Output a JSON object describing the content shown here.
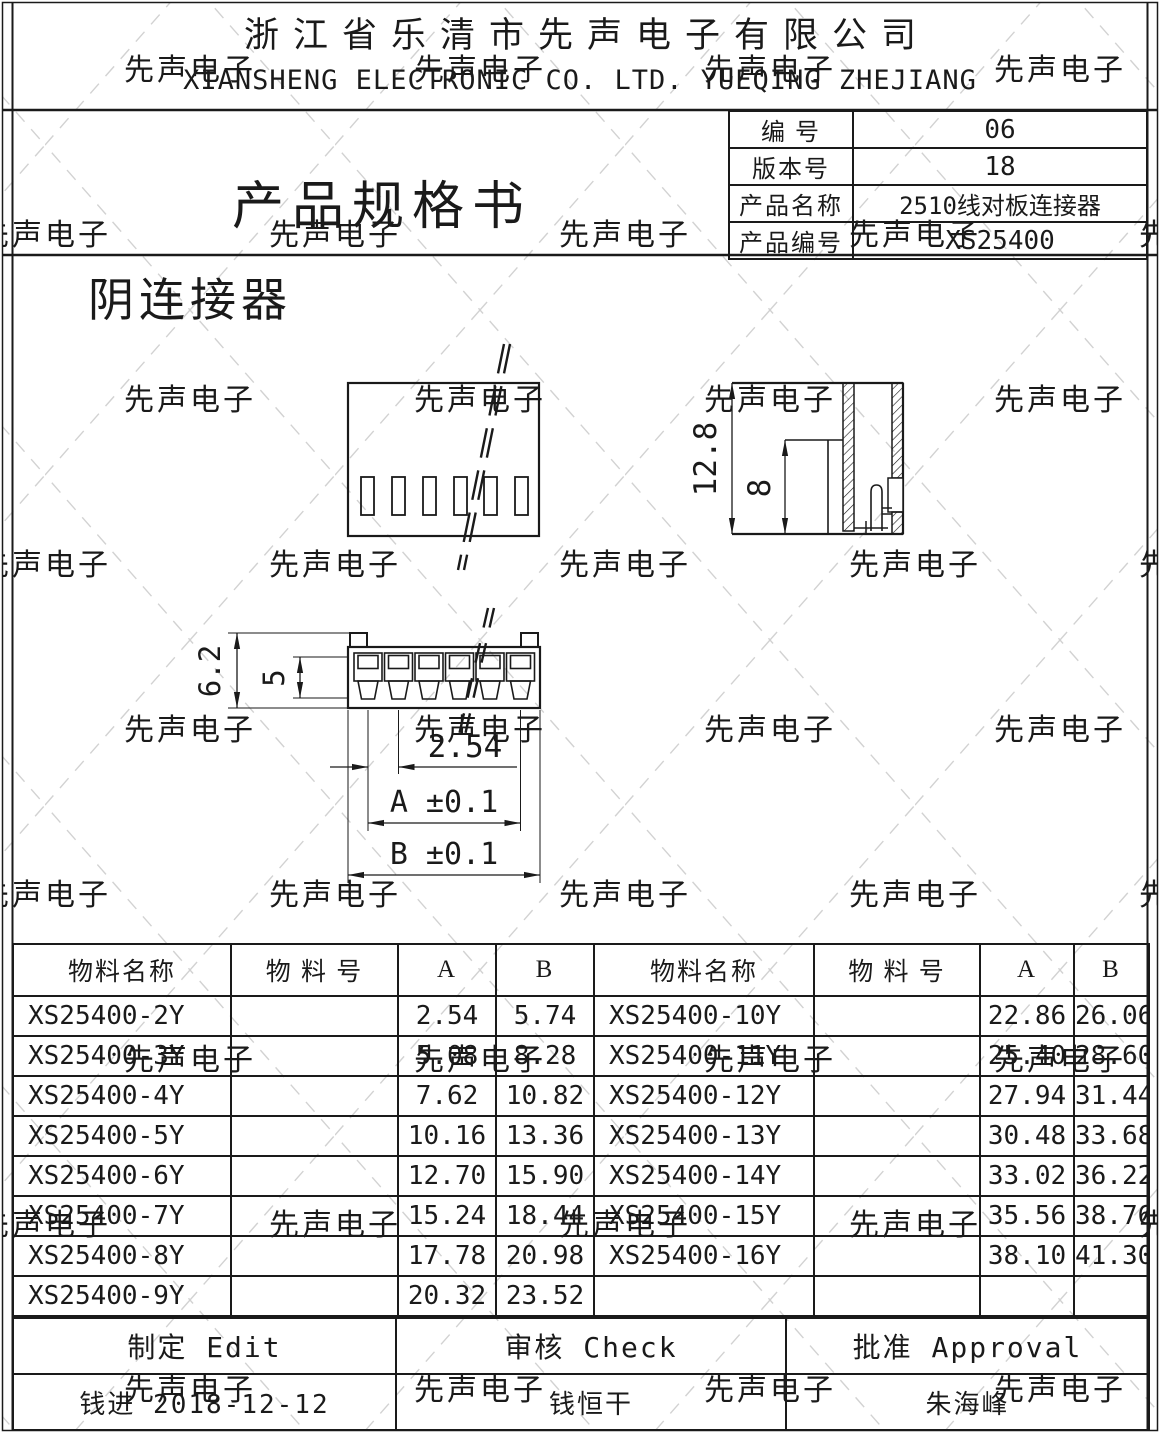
{
  "colors": {
    "ink": "#1a1a1a",
    "watermark_line": "#d2d2d2",
    "watermark_text": "#d6d6d6"
  },
  "watermark": {
    "text": "先声电子"
  },
  "company": {
    "name_cn": "浙江省乐清市先声电子有限公司",
    "name_en": "XIANSHENG ELECTRONIC CO. LTD. YUEQING ZHEJIANG"
  },
  "doc": {
    "title": "产品规格书",
    "info": [
      {
        "label": "编 号",
        "value": "06"
      },
      {
        "label": "版本号",
        "value": "18"
      },
      {
        "label": "产品名称",
        "value": "2510线对板连接器"
      },
      {
        "label": "产品编号",
        "value": "XS25400"
      }
    ]
  },
  "drawing": {
    "section_label": "阴连接器",
    "dims": {
      "overall_height": "12.8",
      "inner_height": "8",
      "overall_width": "6.2",
      "inner_width": "5",
      "pitch": "2.54",
      "dim_a": "A ±0.1",
      "dim_b": "B ±0.1"
    }
  },
  "parts_table": {
    "headers": [
      "物料名称",
      "物 料 号",
      "A",
      "B",
      "物料名称",
      "物 料 号",
      "A",
      "B"
    ],
    "rows": [
      [
        "XS25400-2Y",
        "",
        "2.54",
        "5.74",
        "XS25400-10Y",
        "",
        "22.86",
        "26.06"
      ],
      [
        "XS25400-3Y",
        "",
        "5.08",
        "8.28",
        "XS25400-11Y",
        "",
        "25.40",
        "28.60"
      ],
      [
        "XS25400-4Y",
        "",
        "7.62",
        "10.82",
        "XS25400-12Y",
        "",
        "27.94",
        "31.44"
      ],
      [
        "XS25400-5Y",
        "",
        "10.16",
        "13.36",
        "XS25400-13Y",
        "",
        "30.48",
        "33.68"
      ],
      [
        "XS25400-6Y",
        "",
        "12.70",
        "15.90",
        "XS25400-14Y",
        "",
        "33.02",
        "36.22"
      ],
      [
        "XS25400-7Y",
        "",
        "15.24",
        "18.44",
        "XS25400-15Y",
        "",
        "35.56",
        "38.76"
      ],
      [
        "XS25400-8Y",
        "",
        "17.78",
        "20.98",
        "XS25400-16Y",
        "",
        "38.10",
        "41.30"
      ],
      [
        "XS25400-9Y",
        "",
        "20.32",
        "23.52",
        "",
        "",
        "",
        ""
      ]
    ]
  },
  "footer": {
    "row1": [
      "制定  Edit",
      "审核  Check",
      "批准  Approval"
    ],
    "row2": [
      "钱进 2018-12-12",
      "钱恒干",
      "朱海峰"
    ]
  }
}
